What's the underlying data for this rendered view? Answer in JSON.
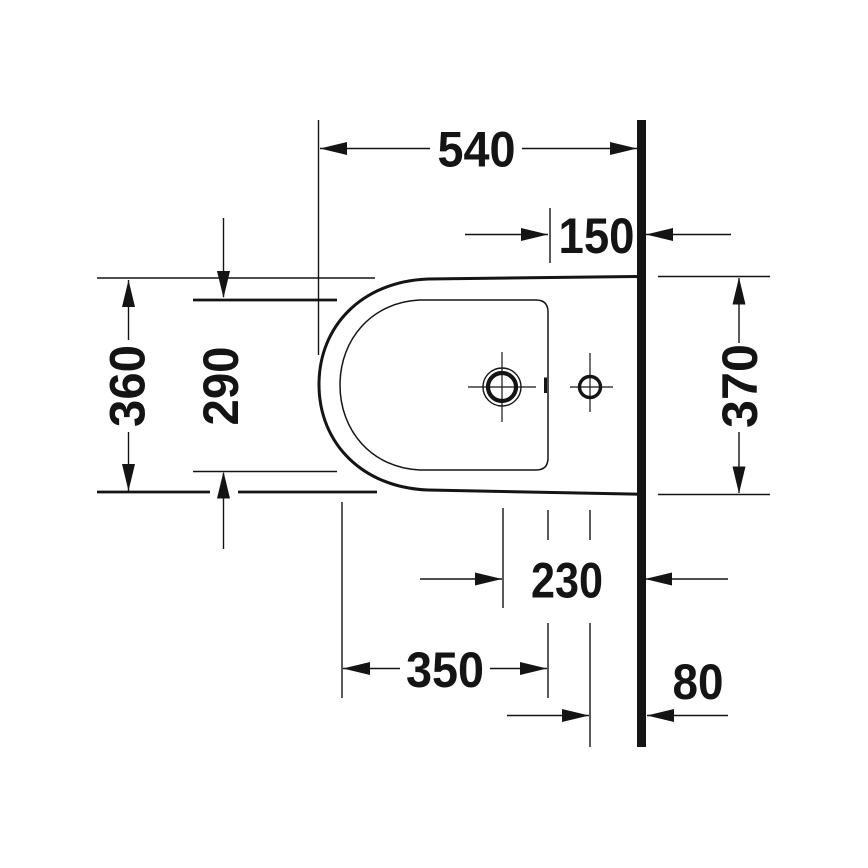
{
  "drawing": {
    "product": "Bidet technical drawing, top view",
    "unit": "mm",
    "ink_color": "#141414",
    "background_color": "#ffffff"
  },
  "dimensions": {
    "overall_length": "540",
    "tap_center_offset": "150",
    "front_outer_width": "360",
    "basin_inner_width": "290",
    "wall_outer_width": "370",
    "tap_center_to_wall": "230",
    "basin_inner_length": "350",
    "outlet_center_to_wall": "80"
  }
}
